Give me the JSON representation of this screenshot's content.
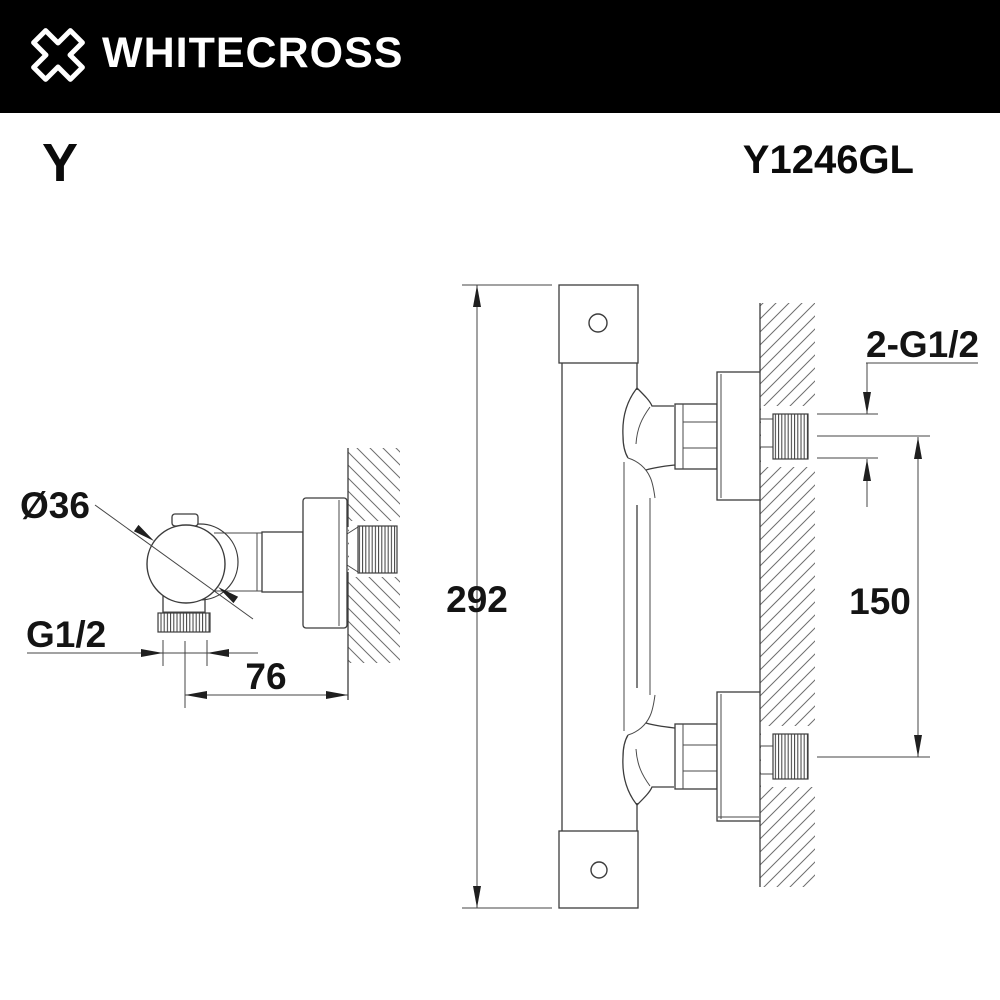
{
  "header": {
    "brand": "WHITECROSS",
    "bg_color": "#000000",
    "fg_color": "#ffffff",
    "logo_icon": "whitecross-x-logo"
  },
  "product": {
    "series": "Y",
    "model": "Y1246GL"
  },
  "drawing": {
    "kind": "technical-dimension-drawing",
    "line_color": "#3c3c3c",
    "side_view": {
      "height_label": "292",
      "port_spacing_label": "150",
      "wall_thread_label": "2-G1/2"
    },
    "top_view": {
      "diameter_label": "Ø36",
      "outlet_thread_label": "G1/2",
      "wall_offset_label": "76"
    }
  }
}
